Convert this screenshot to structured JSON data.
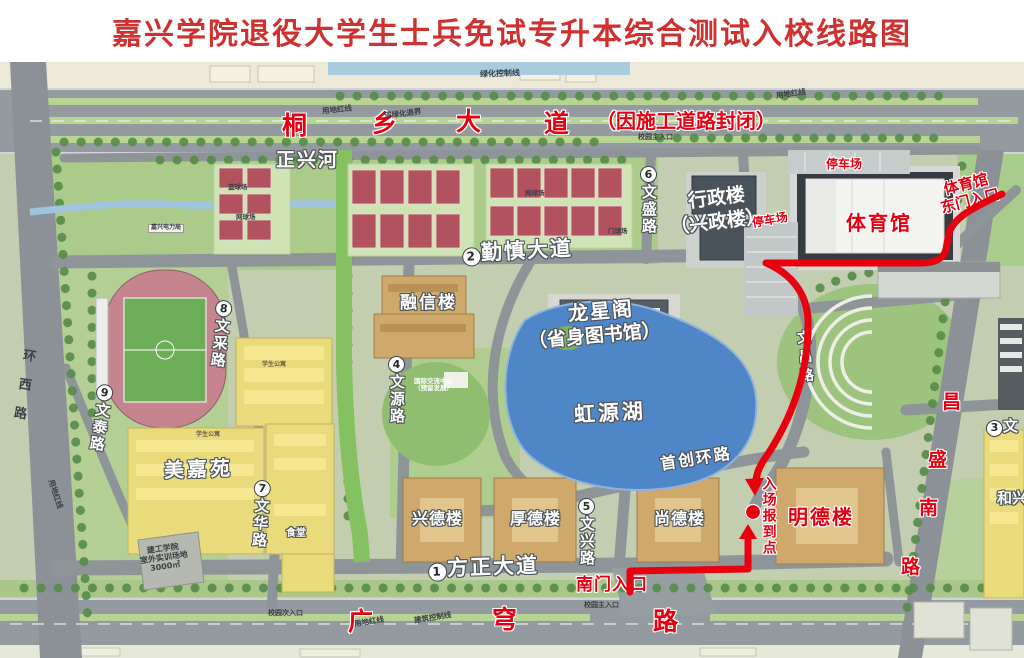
{
  "title": "嘉兴学院退役大学生士兵免试专升本综合测试入校线路图",
  "roads": {
    "tongxiang": {
      "c1": "桐",
      "c2": "乡",
      "c3": "大",
      "c4": "道",
      "closure": "（因施工道路封闭）"
    },
    "qinshen": {
      "num": "2",
      "name": "勤慎大道"
    },
    "fangzheng": {
      "num": "1",
      "name": "方正大道"
    },
    "wenchang_east": {
      "num": "3",
      "partial": "文"
    },
    "wenyuan": {
      "num": "4",
      "name": "文源路"
    },
    "wenxing": {
      "num": "5",
      "name": "文兴路"
    },
    "wensheng": {
      "num": "6",
      "name": "文盛路"
    },
    "wenhua": {
      "num": "7",
      "name": "文华路"
    },
    "wencai": {
      "num": "8",
      "name": "文采路"
    },
    "wentai": {
      "num": "9",
      "name": "文泰路"
    },
    "wenchang": {
      "name": "文昌路"
    },
    "shouchuang": "首创环路",
    "guangqiong": {
      "c1": "广",
      "c2": "穹",
      "c3": "路"
    },
    "changsheng": {
      "c1": "昌",
      "c2": "盛",
      "c3": "南",
      "c4": "路"
    },
    "huanxi": "环西路",
    "river": "正兴河"
  },
  "places": {
    "gym": "体育馆",
    "gym_gate_l1": "体育馆",
    "gym_gate_l2": "东门入口",
    "parking": "停车场",
    "admin_l1": "行政楼",
    "admin_l2": "（兴政楼）",
    "rongxin": "融信楼",
    "longxingge_l1": "龙星阁",
    "longxingge_l2": "（省身图书馆）",
    "lake": "虹源湖",
    "meijiayuan": "美嘉苑",
    "xingde": "兴德楼",
    "houde": "厚德楼",
    "shangde": "尚德楼",
    "mingde": "明德楼",
    "hexing": "和兴",
    "canteen": "食堂",
    "intl_l1": "国际交流中心",
    "intl_l2": "（预留发展）",
    "training_l1": "建工学院",
    "training_l2": "室外实训场地",
    "training_l3": "3000㎡",
    "dorm": "学生公寓",
    "court_basketball": "篮球场",
    "court_tennis": "网球场",
    "court_gate": "门球场",
    "power_sign": "嘉兴电力局"
  },
  "route_labels": {
    "checkin": "入场报到点",
    "south_gate": "南门入口"
  },
  "small": {
    "main_gate": "校园主入口",
    "side_gate": "校园次入口",
    "red_line": "用地红线",
    "build_ctrl": "建筑控制线",
    "green_ctrl": "绿化控制线",
    "river_setback": "河绿化退界"
  },
  "colors": {
    "route": "#e8000f",
    "title_red": "#cf3030",
    "label_red": "#e60012"
  }
}
